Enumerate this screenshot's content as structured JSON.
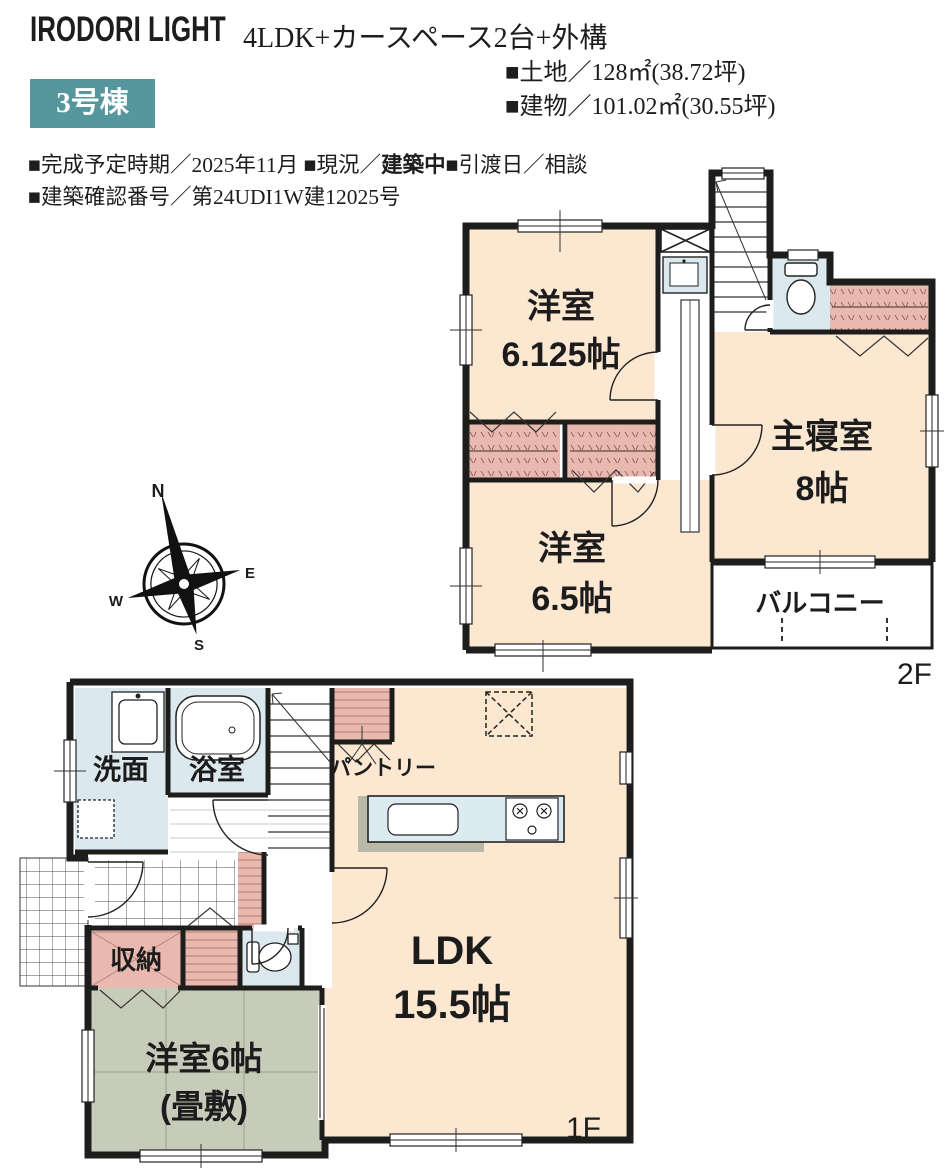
{
  "header": {
    "logo": "IRODORI LIGHT",
    "title": "4LDK+カースペース2台+外構",
    "badge": "3号棟",
    "specs": {
      "land": "■土地／128㎡(38.72坪)",
      "building": "■建物／101.02㎡(30.55坪)"
    },
    "info": {
      "line1_pre": "■完成予定時期／2025年11月 ■現況／",
      "line1_bold": "建築中",
      "line1_post": "■引渡日／相談",
      "line2": "■建築確認番号／第24UDI1W建12025号"
    }
  },
  "compass": {
    "north": "N",
    "east": "E",
    "south": "S",
    "west": "W"
  },
  "floor2": {
    "floor_label": "2F",
    "room_west_name": "洋室",
    "room_west_size": "6.125帖",
    "master_name": "主寝室",
    "master_size": "8帖",
    "room_south_name": "洋室",
    "room_south_size": "6.5帖",
    "balcony": "バルコニー"
  },
  "floor1": {
    "floor_label": "1F",
    "washroom": "洗面",
    "bathroom": "浴室",
    "pantry": "パントリー",
    "ldk_name": "LDK",
    "ldk_size": "15.5帖",
    "storage": "収納",
    "tatami_name": "洋室6帖",
    "tatami_sub": "(畳敷)"
  },
  "colors": {
    "accent_teal": "#55979d",
    "room_peach": "#fce7d1",
    "closet_pink": "#e9b9af",
    "wet_blue": "#dbe9ee",
    "tatami_green": "#c7cbba",
    "wall_black": "#1d1d1b"
  }
}
